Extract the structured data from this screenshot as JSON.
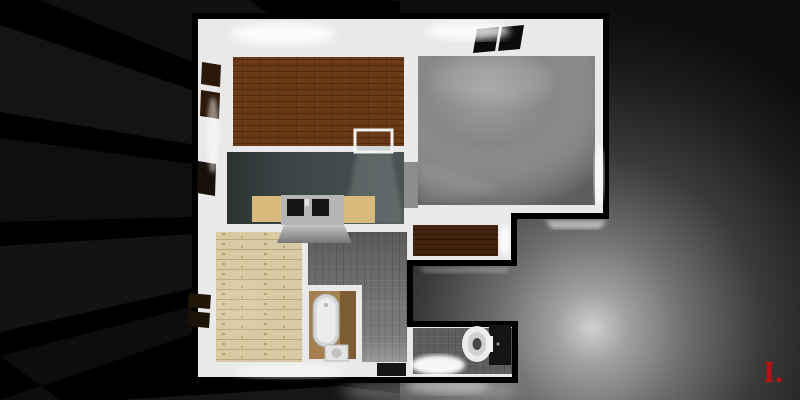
{
  "watermark": {
    "text": "I.",
    "color": "#bb0f14"
  },
  "palette": {
    "background": "#000000",
    "outline": "#000000",
    "wall": "#e9e9e9",
    "brownRoom": "#6b3a16",
    "kitchen": "#3d4a49",
    "living": "#868686",
    "nook": "#44240d",
    "bedroom": "#d8caa2",
    "hallway": "#7d7d7d",
    "bathroomFloor": "#a5804e",
    "wcFloor": "#5e5e5e",
    "counterWood": "#d8ba7d",
    "counterUnit": "#b5b5b5",
    "basin": "#141414",
    "skylight": "#0a0a0a",
    "windowDark": "#2c1809",
    "fixtureWhite": "#ececec",
    "doormat": "#151515",
    "doorwayFloor": "#cfd4d2",
    "glowBright": "#d5d5d5"
  }
}
